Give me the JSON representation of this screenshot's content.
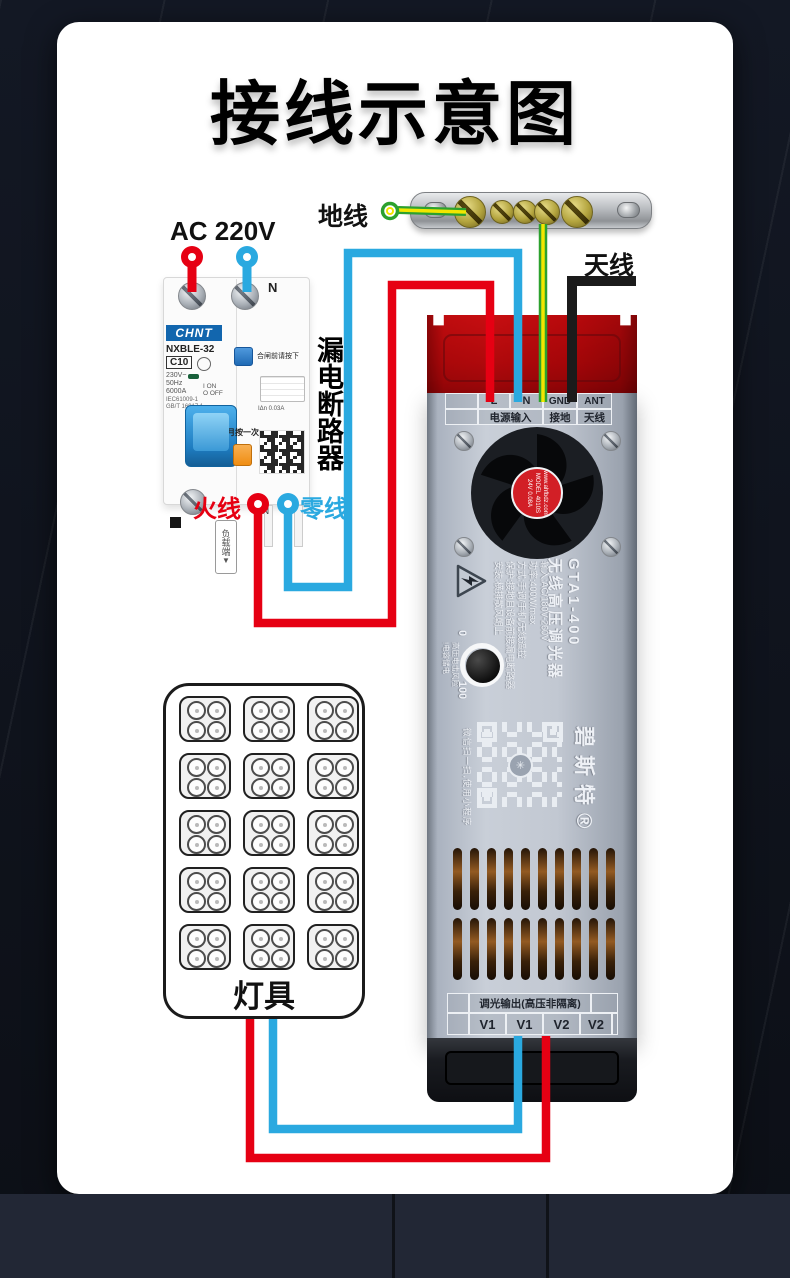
{
  "title": "接线示意图",
  "labels": {
    "ac_input": "AC 220V",
    "ground": "地线",
    "antenna": "天线",
    "live": "火线",
    "neutral": "零线",
    "breaker_name": "漏电断路器",
    "load_side": "负载端",
    "load_side_arrow": "▼",
    "lamp": "灯具"
  },
  "breaker": {
    "brand": "CHNT",
    "model": "NXBLE-32",
    "rating": "C10",
    "voltage": "230V~",
    "frequency": "50Hz",
    "breaking_capacity": "6000A",
    "on_mark": "I ON",
    "off_mark": "O OFF",
    "standard1": "IEC61009-1",
    "standard2": "GB/T 16917.1",
    "neutral_mark": "N",
    "blue_button_note": "合闸前请按下",
    "test_note": "每月按一次",
    "leakage_current": "IΔn 0.03A"
  },
  "dimmer": {
    "input_terminals": [
      "L",
      "N",
      "GND",
      "ANT"
    ],
    "input_terminal_groups": [
      "电源输入",
      "接地",
      "天线"
    ],
    "fan_sticker": [
      "www.ahfbdz.com",
      "MODEL 4010S",
      "24V 0.08A"
    ],
    "model": "GTA1-400",
    "product_name": "无线高压调光器",
    "specs": [
      "输入:AC/180V-260V",
      "功率:400W/max",
      "方式:手调/手机/无线遥控",
      "保护:接地且设备前接漏电断路器",
      "安装:横排散风朝上"
    ],
    "warning_line1": "高压电击风险",
    "warning_line2": "!电容储电",
    "knob_min": "0",
    "knob_max": "100",
    "brand": "碧斯特®",
    "qr_note": "微信扫一扫,使用小程序",
    "output_title": "调光输出(高压非隔离)",
    "output_terminals": [
      "V1",
      "V1",
      "V2",
      "V2"
    ]
  },
  "colors": {
    "wire_live": "#e60013",
    "wire_neutral": "#2aa9e0",
    "wire_ground_green": "#2ca12e",
    "wire_ground_yellow": "#f2e600",
    "wire_antenna": "#1b1b1b",
    "cap_red": "#cf2329",
    "brand_blue": "#1266ae",
    "test_button_orange": "#f59a23"
  }
}
